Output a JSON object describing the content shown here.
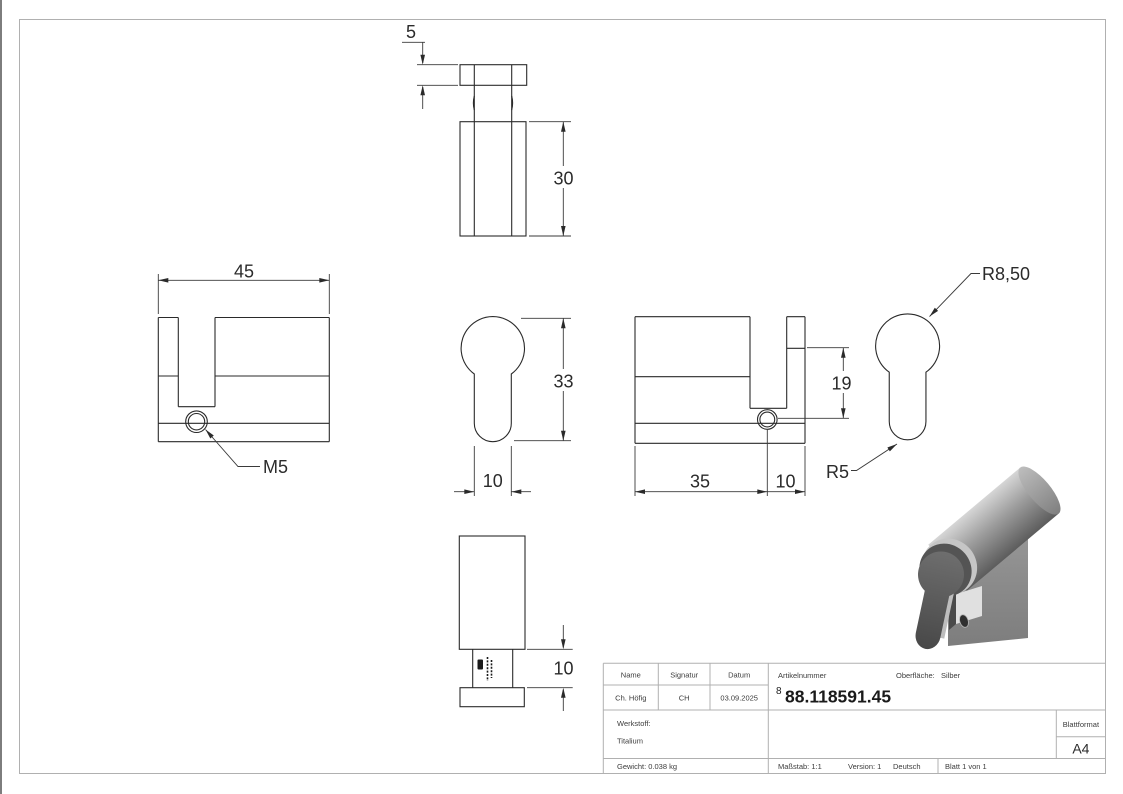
{
  "dims": {
    "d5": "5",
    "d30": "30",
    "d45": "45",
    "d33": "33",
    "d10_front": "10",
    "d35": "35",
    "d10_right": "10",
    "d19": "19",
    "d10_bottom": "10",
    "r850": "R8,50",
    "r5": "R5",
    "m5": "M5"
  },
  "title_block": {
    "name_label": "Name",
    "signatur_label": "Signatur",
    "datum_label": "Datum",
    "name": "Ch. Höfig",
    "signatur": "CH",
    "datum": "03.09.2025",
    "artikelnummer_label": "Artikelnummer",
    "artikelnummer_sup": "8",
    "artikelnummer": "88.118591.45",
    "oberflaeche_label": "Oberfläche:",
    "oberflaeche": "Silber",
    "werkstoff_label": "Werkstoff:",
    "werkstoff": "Titalium",
    "gewicht": "Gewicht: 0.038 kg",
    "massstab": "Maßstab: 1:1",
    "version": "Version: 1",
    "sprache": "Deutsch",
    "blatt": "Blatt 1 von 1",
    "blattformat_label": "Blattformat",
    "blattformat": "A4"
  },
  "colors": {
    "line": "#2a2a2a",
    "table_line": "#b0b0b0",
    "frame": "#d6d6d6",
    "render_light": "#d6d6d6",
    "render_dark": "#4a4a4a"
  }
}
